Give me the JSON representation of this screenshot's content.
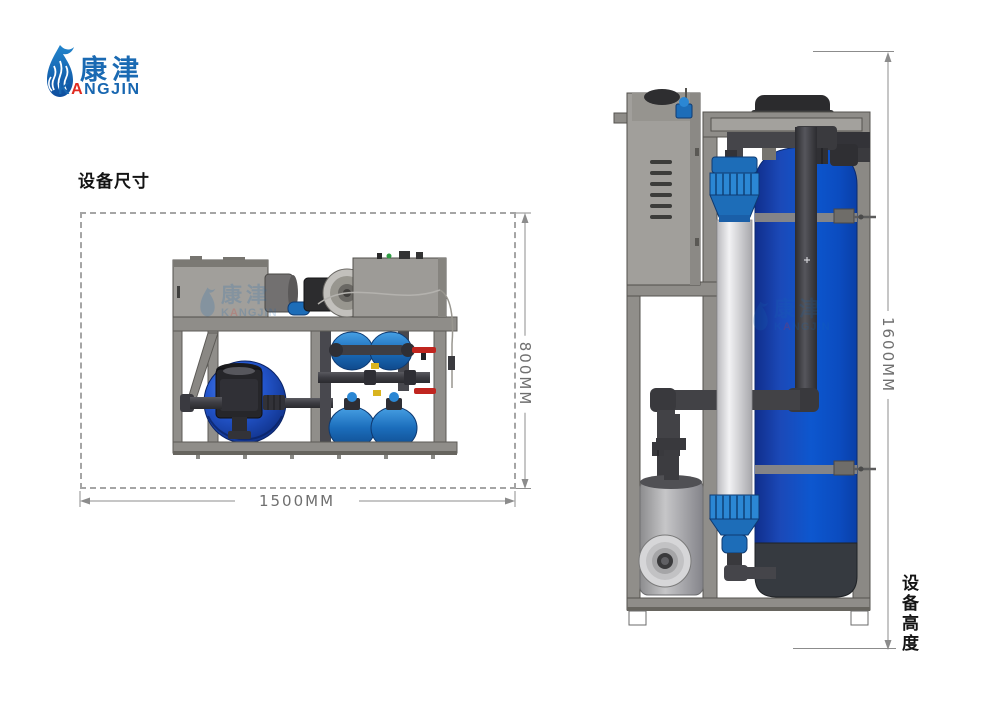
{
  "brand": {
    "chinese": "康津",
    "latin": "KANGJIN",
    "latin_prefix": "K",
    "latin_accent": "A",
    "latin_suffix": "NGJIN",
    "logo_blue": "#1766b0",
    "logo_red": "#e02b20"
  },
  "labels": {
    "dimensions_title": "设备尺寸",
    "height_label": "设备高度"
  },
  "dimensions": {
    "width": "1500MM",
    "depth": "800MM",
    "height": "1600MM"
  },
  "colors": {
    "frame_gray": "#8f8d89",
    "cabinet_gray": "#a19f9b",
    "pipe_dark": "#45454a",
    "tank_blue": "#0d56cc",
    "fitting_blue": "#2b87d4",
    "valve_red": "#c0251f",
    "dimension_line_gray": "#8c8c8c"
  }
}
